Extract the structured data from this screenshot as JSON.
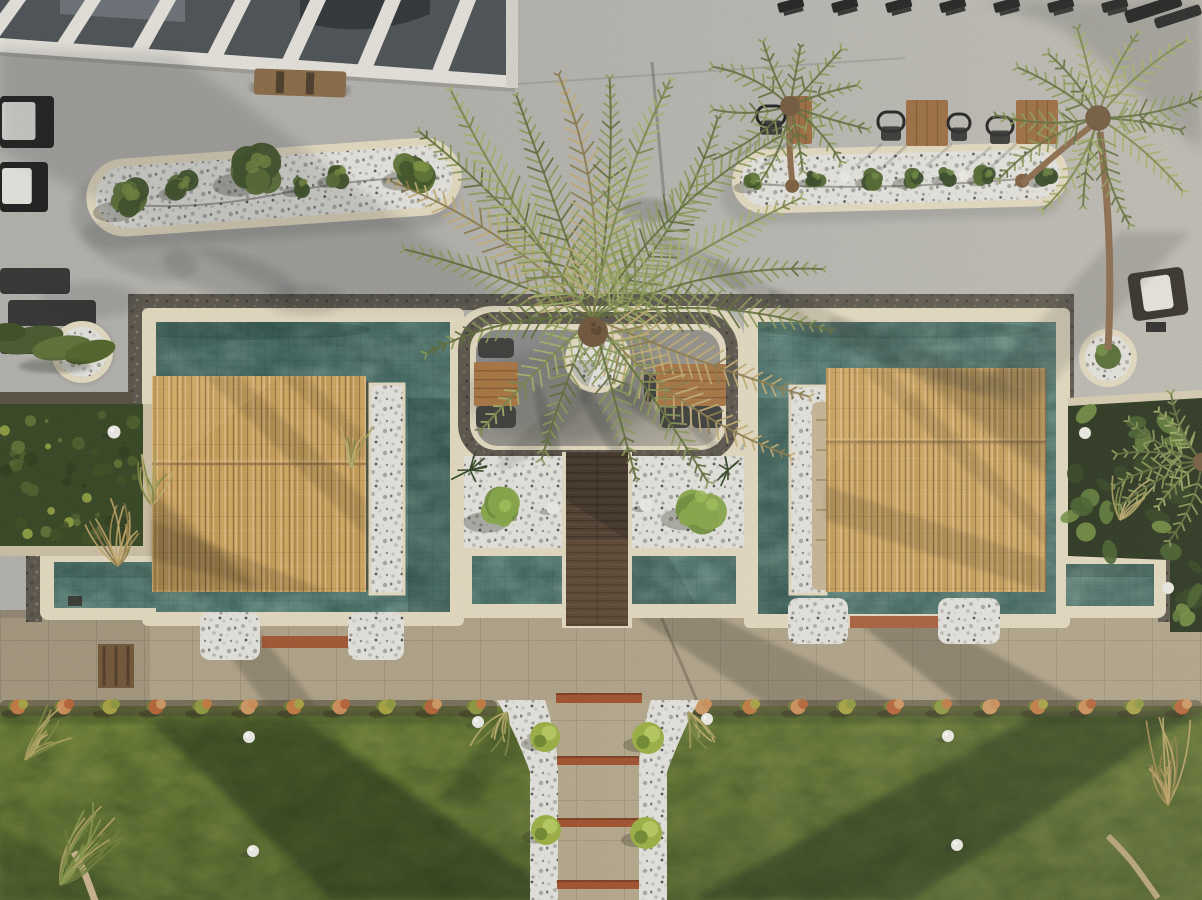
{
  "scene": {
    "description": "Aerial top-down drone view at golden hour of a resort pool terrace: a wrap-around turquoise tiled pool with two straw-thatched cabanas, a large central palm tree in a round pebble planter, white-pebble topiary planters, cafe tables and loungers on a speckled stone terrace, a paver walkway edged with orange flowering shrubs, and a lawn crossed by a white-pebble garden path with timber steps.",
    "time_of_day": "late afternoon, long shadows"
  },
  "palette": {
    "pav": "#b4b3ae",
    "pavLight": "#cfccc3",
    "pavShade": "#8e9091",
    "peninsula": "#8f8e89",
    "peninsulaLit": "#bcb5a5",
    "coping": "#e7ddc3",
    "copingShade": "#c9bda1",
    "darkband": "#5a544a",
    "water1": "#416a62",
    "water2": "#5d8a80",
    "water3": "#477169",
    "pebble": "#e8e7e2",
    "thatch": "#caa05c",
    "deck": "#4e3b2b",
    "deckLine": "#392b1f",
    "walk": "#b2a489",
    "walkShade": "#847862",
    "lawn1": "#66792f",
    "lawn2": "#4f612a",
    "lawnShadow": "#16280e",
    "hedge": "#33441f",
    "bedDark": "#202c15",
    "wood": "#9c6a3c",
    "woodDark": "#6f4b2a",
    "cream": "#e7ddc3",
    "white": "#f0efe9",
    "terracotta": "#a24e28",
    "black": "#1b1b1b",
    "greenBush": "#3f5426",
    "greenLite": "#5d7433",
    "greenHi": "#7a9140",
    "lime": "#9cb240",
    "palmGreen": "#8a9a55",
    "palmLite": "#a9b36a",
    "palmDry": "#c4ae72",
    "grassTan": "#b9a05c",
    "roof": "#4a5054",
    "roofDark": "#2c3236",
    "beam": "#e9e6df",
    "daybed": "#c9b695"
  },
  "objects": {
    "left_planter": {
      "cx": 275,
      "cy": 187,
      "angle": -4,
      "x": 86,
      "y": 148,
      "w": 376,
      "h": 78,
      "bushes": [
        [
          128,
          190,
          26
        ],
        [
          182,
          180,
          17
        ],
        [
          255,
          170,
          30
        ],
        [
          300,
          188,
          13
        ],
        [
          338,
          180,
          15
        ],
        [
          415,
          180,
          24
        ]
      ]
    },
    "right_planter": {
      "x": 732,
      "y": 146,
      "w": 336,
      "h": 64,
      "angle": -1.5,
      "bushes": [
        [
          753,
          178,
          14
        ],
        [
          815,
          176,
          12
        ],
        [
          873,
          177,
          13
        ],
        [
          912,
          178,
          14
        ],
        [
          948,
          177,
          12
        ],
        [
          985,
          178,
          13
        ],
        [
          1045,
          180,
          14
        ]
      ],
      "trunks": [
        [
          792,
          183
        ],
        [
          1022,
          184
        ]
      ],
      "lamps": [
        [
          845,
          176
        ],
        [
          963,
          177
        ]
      ]
    },
    "tables_top": [
      [
        906,
        100,
        42,
        46
      ],
      [
        1016,
        100,
        42,
        44
      ],
      [
        786,
        96,
        26,
        48
      ]
    ],
    "chairs_top": [
      [
        878,
        112,
        26,
        32
      ],
      [
        948,
        114,
        22,
        30
      ],
      [
        987,
        117,
        26,
        30
      ],
      [
        757,
        106,
        28,
        32
      ]
    ],
    "top_chair_row_xs": [
      778,
      832,
      886,
      940,
      994,
      1048,
      1102
    ],
    "left_loungers": [
      [
        0,
        96,
        54,
        52
      ],
      [
        0,
        162,
        48,
        50
      ]
    ],
    "left_dark_set": [
      [
        0,
        268,
        70,
        26
      ],
      [
        8,
        300,
        88,
        26
      ],
      [
        0,
        332,
        60,
        22
      ]
    ],
    "peninsula_tables": [
      [
        474,
        362,
        44,
        44
      ],
      [
        656,
        364,
        70,
        42
      ]
    ],
    "peninsula_loungers": [
      [
        478,
        338,
        36,
        20
      ],
      [
        476,
        406,
        40,
        22
      ],
      [
        660,
        406,
        30,
        22
      ],
      [
        692,
        406,
        30,
        22
      ],
      [
        644,
        372,
        12,
        30
      ]
    ],
    "pebble_bushes": [
      [
        500,
        512,
        26
      ],
      [
        700,
        508,
        28
      ]
    ],
    "pebble_lamps": [
      [
        553,
        508
      ],
      [
        646,
        505
      ]
    ],
    "spiky": [
      [
        470,
        470
      ],
      [
        728,
        470
      ]
    ]
  },
  "palms": {
    "center": {
      "cx": 593,
      "cy": 318,
      "crown": [
        593,
        332,
        15
      ],
      "fronds": [
        [
          -160,
          200,
          "g"
        ],
        [
          -146,
          245,
          "dry"
        ],
        [
          -133,
          255,
          "g"
        ],
        [
          -122,
          268,
          "lite"
        ],
        [
          -109,
          235,
          "g"
        ],
        [
          -98,
          245,
          "dry"
        ],
        [
          -86,
          240,
          "g"
        ],
        [
          -72,
          250,
          "lite"
        ],
        [
          -58,
          235,
          "g"
        ],
        [
          -44,
          262,
          "g"
        ],
        [
          -30,
          240,
          "lite"
        ],
        [
          -12,
          235,
          "g"
        ],
        [
          3,
          237,
          "g"
        ],
        [
          20,
          230,
          "dry"
        ],
        [
          35,
          240,
          "dry"
        ],
        [
          55,
          200,
          "g"
        ],
        [
          75,
          165,
          "g"
        ],
        [
          110,
          150,
          "g"
        ],
        [
          135,
          158,
          "lite"
        ],
        [
          168,
          170,
          "g"
        ]
      ]
    },
    "clusters": [
      {
        "cx": 790,
        "cy": 106,
        "r0": 60,
        "r1": 100,
        "n": 11,
        "seed": 11,
        "a0": 0,
        "a1": 360
      },
      {
        "cx": 1098,
        "cy": 118,
        "r0": 80,
        "r1": 128,
        "n": 13,
        "seed": 23,
        "a0": 0,
        "a1": 360
      },
      {
        "cx": 1202,
        "cy": 462,
        "r0": 50,
        "r1": 92,
        "n": 8,
        "seed": 31,
        "a0": 100,
        "a1": 260
      }
    ]
  },
  "garden": {
    "flowers_left_xs": [
      18,
      64,
      110,
      156,
      202,
      248,
      294,
      340,
      386,
      432,
      476
    ],
    "flowers_right_xs": [
      702,
      750,
      798,
      846,
      894,
      942,
      990,
      1038,
      1086,
      1134,
      1182
    ],
    "flower_colors": [
      "#c47a40",
      "#cf8f58",
      "#a8a441",
      "#b96335",
      "#8f9a3d",
      "#d19a62"
    ],
    "path": {
      "bars": [
        [
          556,
          693,
          86,
          10
        ],
        [
          557,
          756,
          82,
          9
        ],
        [
          557,
          818,
          82,
          9
        ],
        [
          557,
          880,
          82,
          9
        ]
      ],
      "bushes": [
        [
          545,
          737,
          15
        ],
        [
          648,
          738,
          16
        ],
        [
          546,
          830,
          15
        ],
        [
          646,
          833,
          16
        ]
      ],
      "lamps": [
        [
          478,
          722
        ],
        [
          707,
          719
        ]
      ]
    },
    "lawn_lamps": [
      [
        249,
        737
      ],
      [
        253,
        851
      ],
      [
        948,
        736
      ],
      [
        957,
        845
      ]
    ],
    "bed_lamps": [
      [
        1085,
        433
      ],
      [
        1168,
        588
      ]
    ],
    "hedge_lamp": [
      114,
      432
    ],
    "round_planters": [
      [
        82,
        352,
        28
      ],
      [
        1108,
        358,
        26
      ]
    ],
    "grass_tufts": [
      {
        "x": 118,
        "y": 566,
        "dir": -95,
        "spread": 75,
        "n": 16,
        "len": 62,
        "c": "tan"
      },
      {
        "x": 152,
        "y": 505,
        "dir": -80,
        "spread": 60,
        "n": 12,
        "len": 50,
        "c": "mix"
      },
      {
        "x": 60,
        "y": 885,
        "dir": -60,
        "spread": 55,
        "n": 20,
        "len": 78,
        "c": "lawn"
      },
      {
        "x": 25,
        "y": 760,
        "dir": -45,
        "spread": 50,
        "n": 12,
        "len": 55,
        "c": "mix"
      },
      {
        "x": 1168,
        "y": 805,
        "dir": -100,
        "spread": 50,
        "n": 15,
        "len": 75,
        "c": "tan"
      },
      {
        "x": 507,
        "y": 712,
        "dir": 115,
        "spread": 55,
        "n": 10,
        "len": 42,
        "c": "mix"
      },
      {
        "x": 688,
        "y": 712,
        "dir": 65,
        "spread": 55,
        "n": 10,
        "len": 42,
        "c": "mix"
      },
      {
        "x": 1120,
        "y": 520,
        "dir": -70,
        "spread": 60,
        "n": 10,
        "len": 45,
        "c": "mix"
      },
      {
        "x": 352,
        "y": 468,
        "dir": -85,
        "spread": 50,
        "n": 8,
        "len": 40,
        "c": "mix"
      }
    ],
    "hedge_dots_n": 46,
    "bed_foliage_n": 30
  }
}
